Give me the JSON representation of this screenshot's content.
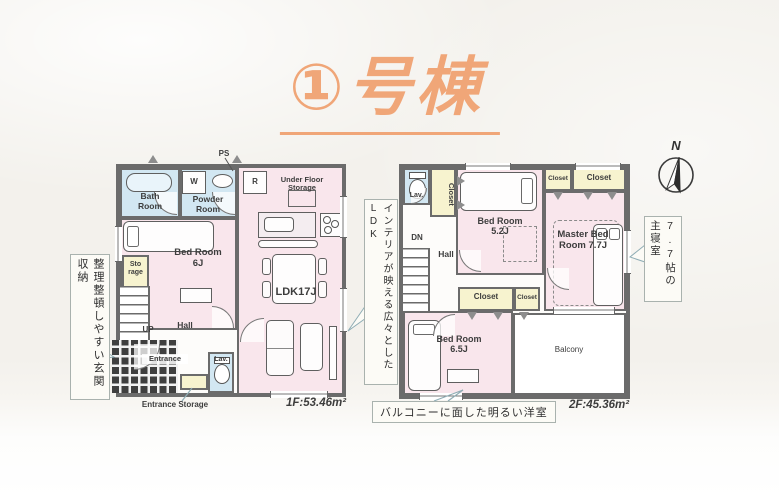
{
  "title": "①号棟",
  "compass": {
    "north_label": "N"
  },
  "floor1": {
    "area": "1F:53.46m²",
    "labels": {
      "ps": "PS",
      "washer": "W",
      "fridge": "R",
      "bath": "Bath Room",
      "powder": "Powder Room",
      "under_floor_storage": "Under Floor Storage",
      "ldk": "LDK17J",
      "bedroom": "Bed Room 6J",
      "storage": "Sto rage",
      "up": "UP",
      "hall": "Hall",
      "entrance": "Entrance",
      "lav": "Lav.",
      "entrance_storage": "Entrance Storage"
    }
  },
  "floor2": {
    "area": "2F:45.36m²",
    "labels": {
      "lav": "Lav.",
      "closet": "Closet",
      "bedroom_52": "Bed Room 5.2J",
      "master_bedroom": "Master Bed Room 7.7J",
      "dn": "DN",
      "hall": "Hall",
      "bedroom_65": "Bed Room 6.5J",
      "balcony": "Balcony"
    }
  },
  "callouts": {
    "entrance_storage": "整理整頓しやすい玄関収納",
    "ldk": "インテリアが映える広々としたLDK",
    "master_bedroom": "7.7帖の主寝室",
    "bright_room": "バルコニーに面した明るい洋室"
  },
  "colors": {
    "accent_title": "#f0a678",
    "room_pink": "#f9e6ec",
    "wet_blue": "#d2e7f2",
    "closet_yellow": "#f7f3cf",
    "wall_gray": "#6b6b6b",
    "callout_line": "#8fadb5"
  }
}
